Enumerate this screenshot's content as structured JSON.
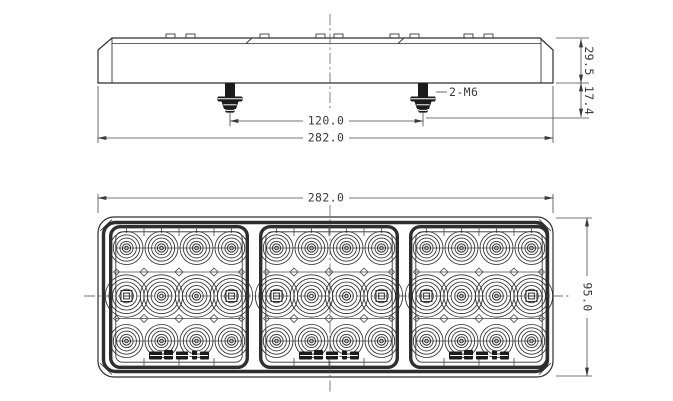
{
  "canvas": {
    "background": "#ffffff",
    "line_color": "#2e2e2e",
    "dim_color": "#474747"
  },
  "side_view": {
    "dim_bolt_spacing": "120.0",
    "dim_overall_width": "282.0",
    "bolt_spec": "2-M6",
    "dim_body_height": "29.5",
    "dim_bolt_protrusion": "17.4",
    "bolt_count": 2
  },
  "front_view": {
    "dim_overall_width": "282.0",
    "dim_overall_height": "95.0",
    "panel_count": 3,
    "led_columns": 4,
    "led_rows": 3,
    "leds_per_panel": 12
  }
}
